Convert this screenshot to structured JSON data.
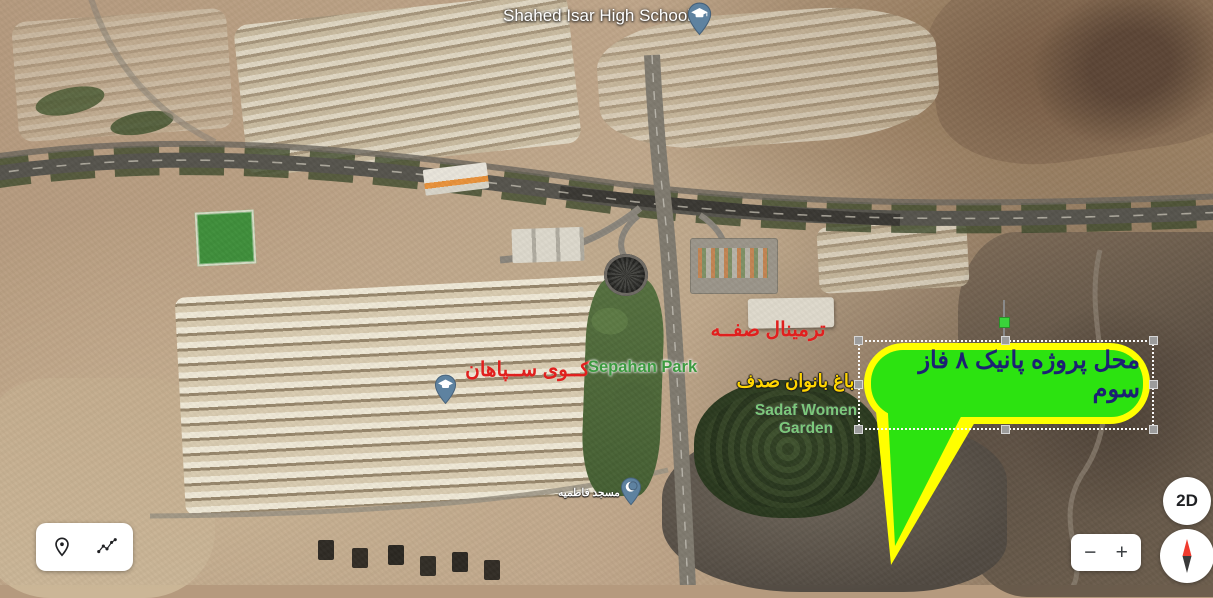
{
  "view": {
    "type": "satellite-3d-map",
    "bottom_bar_color": "#1c1c22"
  },
  "labels": {
    "high_school": "Shahed Isar High School",
    "terminal": "ترمینال صفــه",
    "kuy_sepahan": "کــوی ســپاهان",
    "sepahan_park": "Sepahan Park",
    "women_garden_fa": "باغ بانوان صدف",
    "women_garden_en_line1": "Sadaf Women",
    "women_garden_en_line2": "Garden",
    "mosque": "مسجد فاطمیه"
  },
  "callout": {
    "text": "محل پروژه پانیک ۸ فاز سوم",
    "selected": true
  },
  "controls": {
    "view_toggle": "2D",
    "zoom_in": "+",
    "zoom_out": "−",
    "tools": [
      {
        "name": "placemark-tool",
        "icon": "location-pin-icon"
      },
      {
        "name": "path-tool",
        "icon": "path-icon"
      }
    ],
    "compass_icon": "compass-needle-icon"
  },
  "icons": {
    "school_pin": "graduation-cap-pin-icon",
    "sepahan_pin": "graduation-cap-pin-icon",
    "mosque_pin": "crescent-pin-icon",
    "edge_pin": "partial-poi-pin-icon"
  },
  "colors": {
    "callout_fill": "#2ce310",
    "callout_border": "#ffff00",
    "callout_text": "#1c2173",
    "label_red": "#e0201e",
    "park_green": "#3c9a40",
    "garden_green": "#7cc87c",
    "garden_yellow": "#ffd500",
    "pin_fill": "#5e82a0",
    "pin_stroke": "#46617a",
    "edge_pin": "#19a0b8"
  }
}
